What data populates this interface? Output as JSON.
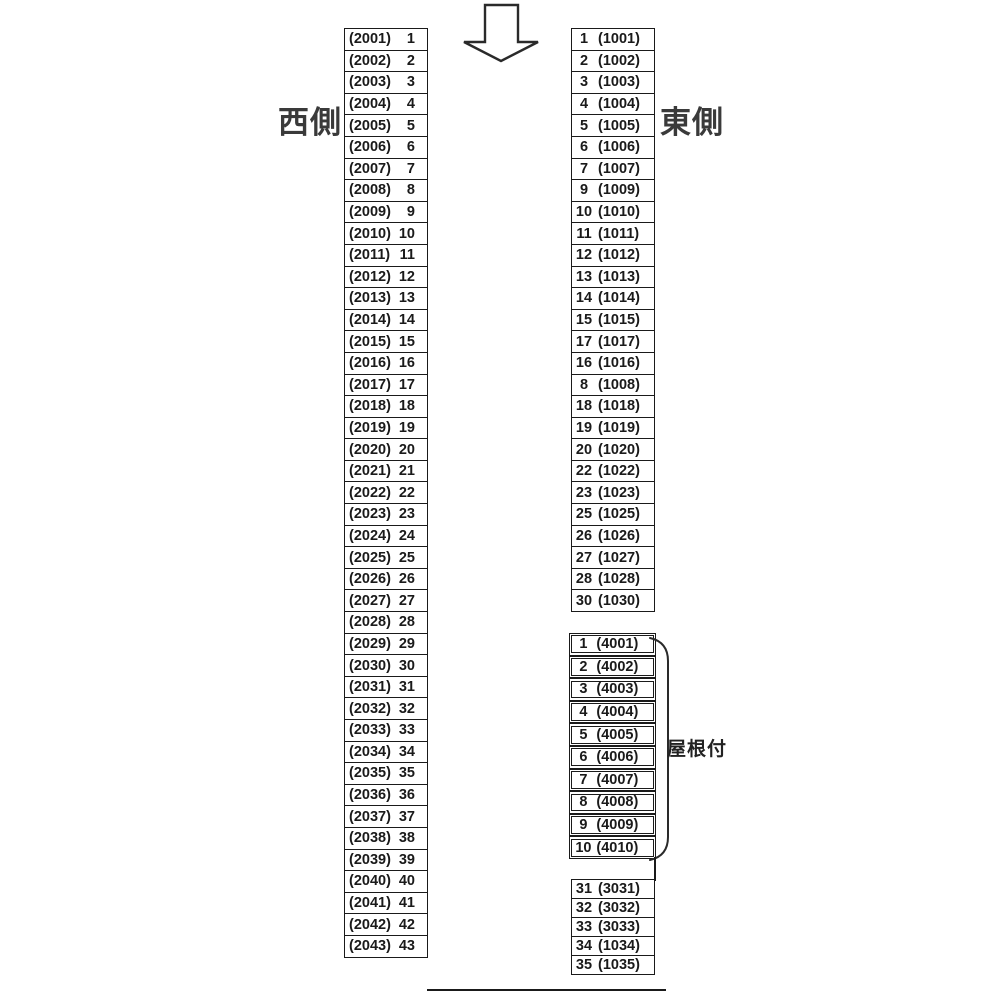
{
  "page": {
    "background": "#ffffff",
    "line_color": "#1a1a1a",
    "label_color": "#3a3a3a"
  },
  "labels": {
    "west_side": "西側",
    "east_side": "東側",
    "roofed": "屋根付"
  },
  "icons": {
    "direction_arrow": "down-arrow"
  },
  "west_column": [
    {
      "code": "(2001)",
      "num": "1"
    },
    {
      "code": "(2002)",
      "num": "2"
    },
    {
      "code": "(2003)",
      "num": "3"
    },
    {
      "code": "(2004)",
      "num": "4"
    },
    {
      "code": "(2005)",
      "num": "5"
    },
    {
      "code": "(2006)",
      "num": "6"
    },
    {
      "code": "(2007)",
      "num": "7"
    },
    {
      "code": "(2008)",
      "num": "8"
    },
    {
      "code": "(2009)",
      "num": "9"
    },
    {
      "code": "(2010)",
      "num": "10"
    },
    {
      "code": "(2011)",
      "num": "11"
    },
    {
      "code": "(2012)",
      "num": "12"
    },
    {
      "code": "(2013)",
      "num": "13"
    },
    {
      "code": "(2014)",
      "num": "14"
    },
    {
      "code": "(2015)",
      "num": "15"
    },
    {
      "code": "(2016)",
      "num": "16"
    },
    {
      "code": "(2017)",
      "num": "17"
    },
    {
      "code": "(2018)",
      "num": "18"
    },
    {
      "code": "(2019)",
      "num": "19"
    },
    {
      "code": "(2020)",
      "num": "20"
    },
    {
      "code": "(2021)",
      "num": "21"
    },
    {
      "code": "(2022)",
      "num": "22"
    },
    {
      "code": "(2023)",
      "num": "23"
    },
    {
      "code": "(2024)",
      "num": "24"
    },
    {
      "code": "(2025)",
      "num": "25"
    },
    {
      "code": "(2026)",
      "num": "26"
    },
    {
      "code": "(2027)",
      "num": "27"
    },
    {
      "code": "(2028)",
      "num": "28"
    },
    {
      "code": "(2029)",
      "num": "29"
    },
    {
      "code": "(2030)",
      "num": "30"
    },
    {
      "code": "(2031)",
      "num": "31"
    },
    {
      "code": "(2032)",
      "num": "32"
    },
    {
      "code": "(2033)",
      "num": "33"
    },
    {
      "code": "(2034)",
      "num": "34"
    },
    {
      "code": "(2035)",
      "num": "35"
    },
    {
      "code": "(2036)",
      "num": "36"
    },
    {
      "code": "(2037)",
      "num": "37"
    },
    {
      "code": "(2038)",
      "num": "38"
    },
    {
      "code": "(2039)",
      "num": "39"
    },
    {
      "code": "(2040)",
      "num": "40"
    },
    {
      "code": "(2041)",
      "num": "41"
    },
    {
      "code": "(2042)",
      "num": "42"
    },
    {
      "code": "(2043)",
      "num": "43"
    }
  ],
  "east_top": [
    {
      "num": "1",
      "code": "(1001)"
    },
    {
      "num": "2",
      "code": "(1002)"
    },
    {
      "num": "3",
      "code": "(1003)"
    },
    {
      "num": "4",
      "code": "(1004)"
    },
    {
      "num": "5",
      "code": "(1005)"
    },
    {
      "num": "6",
      "code": "(1006)"
    },
    {
      "num": "7",
      "code": "(1007)"
    },
    {
      "num": "9",
      "code": "(1009)"
    },
    {
      "num": "10",
      "code": "(1010)"
    },
    {
      "num": "11",
      "code": "(1011)"
    },
    {
      "num": "12",
      "code": "(1012)"
    },
    {
      "num": "13",
      "code": "(1013)"
    },
    {
      "num": "14",
      "code": "(1014)"
    },
    {
      "num": "15",
      "code": "(1015)"
    },
    {
      "num": "17",
      "code": "(1017)"
    },
    {
      "num": "16",
      "code": "(1016)"
    },
    {
      "num": "8",
      "code": "(1008)"
    },
    {
      "num": "18",
      "code": "(1018)"
    },
    {
      "num": "19",
      "code": "(1019)"
    },
    {
      "num": "20",
      "code": "(1020)"
    },
    {
      "num": "22",
      "code": "(1022)"
    },
    {
      "num": "23",
      "code": "(1023)"
    },
    {
      "num": "25",
      "code": "(1025)"
    },
    {
      "num": "26",
      "code": "(1026)"
    },
    {
      "num": "27",
      "code": "(1027)"
    },
    {
      "num": "28",
      "code": "(1028)"
    },
    {
      "num": "30",
      "code": "(1030)"
    }
  ],
  "east_roofed": [
    {
      "num": "1",
      "code": "(4001)"
    },
    {
      "num": "2",
      "code": "(4002)"
    },
    {
      "num": "3",
      "code": "(4003)"
    },
    {
      "num": "4",
      "code": "(4004)"
    },
    {
      "num": "5",
      "code": "(4005)"
    },
    {
      "num": "6",
      "code": "(4006)"
    },
    {
      "num": "7",
      "code": "(4007)"
    },
    {
      "num": "8",
      "code": "(4008)"
    },
    {
      "num": "9",
      "code": "(4009)"
    },
    {
      "num": "10",
      "code": "(4010)"
    }
  ],
  "east_bottom": [
    {
      "num": "31",
      "code": "(3031)"
    },
    {
      "num": "32",
      "code": "(3032)"
    },
    {
      "num": "33",
      "code": "(3033)"
    },
    {
      "num": "34",
      "code": "(1034)"
    },
    {
      "num": "35",
      "code": "(1035)"
    }
  ]
}
